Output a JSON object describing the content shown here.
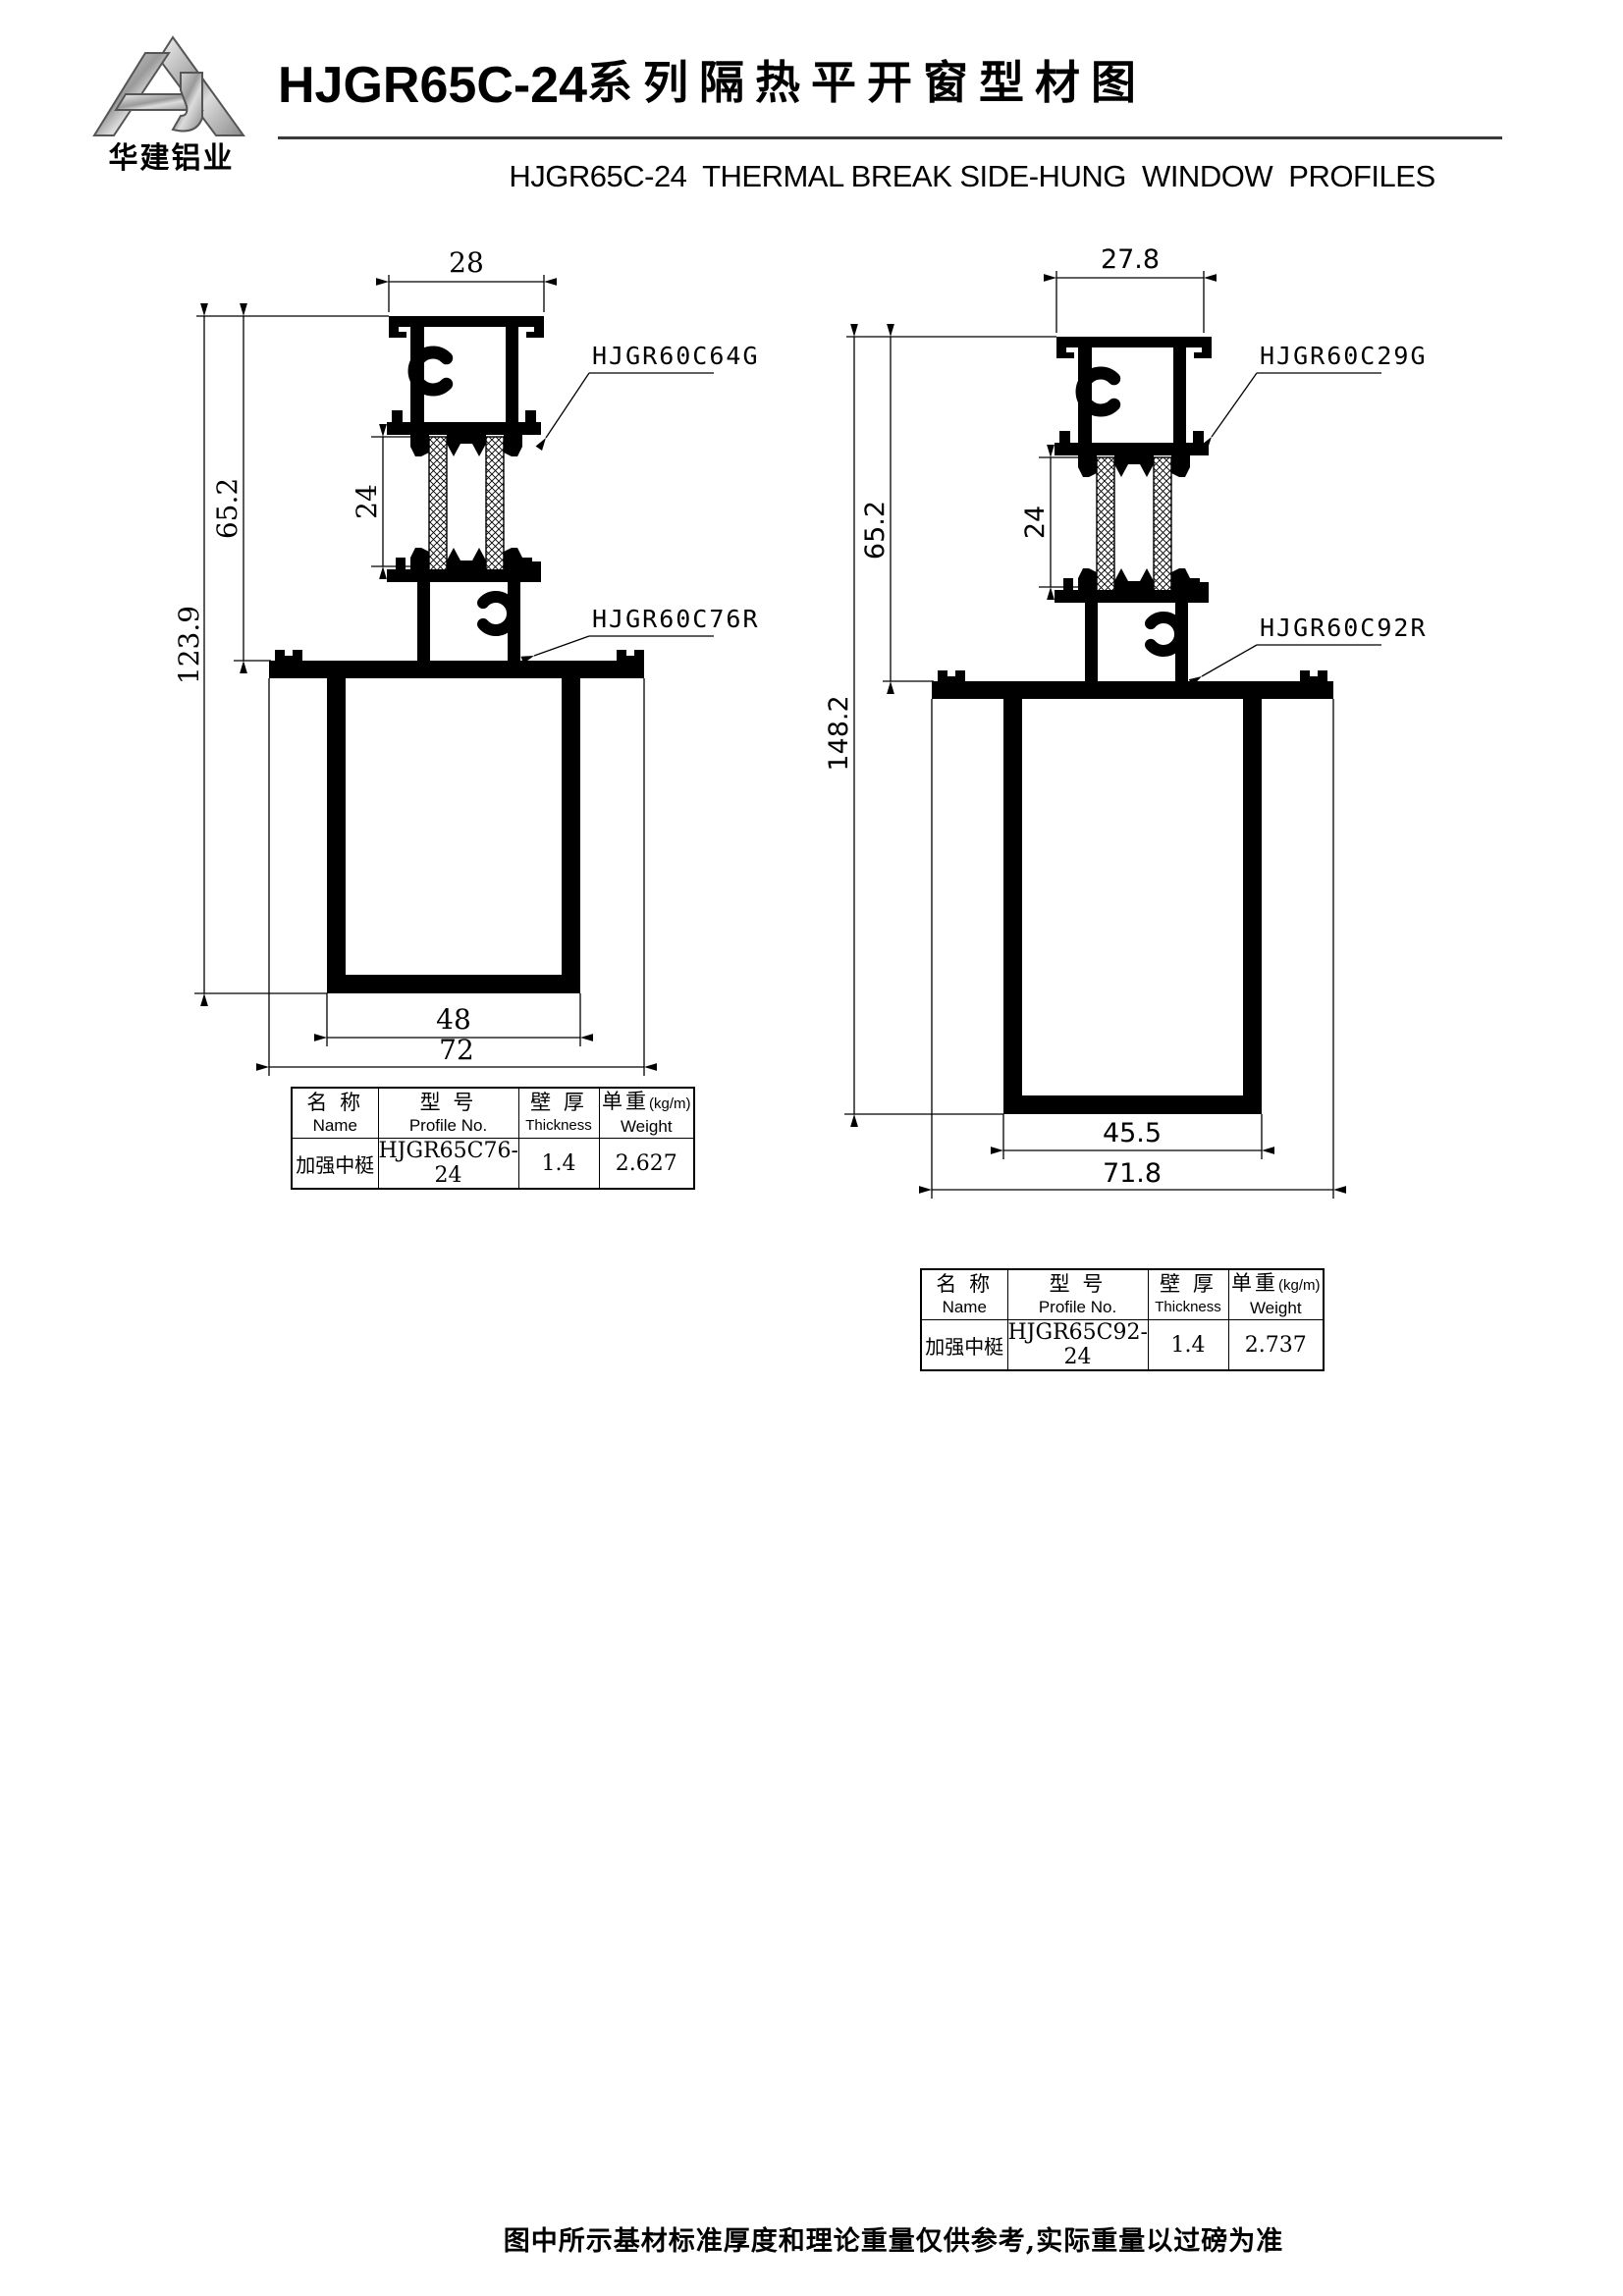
{
  "header": {
    "logo_company": "华建铝业",
    "title_model": "HJGR65C-24",
    "title_text": "系列隔热平开窗型材图",
    "subtitle": "HJGR65C-24  THERMAL BREAK SIDE-HUNG  WINDOW  PROFILES"
  },
  "drawings": [
    {
      "side": "left",
      "top_profile_label": "HJGR60C64G",
      "bottom_profile_label": "HJGR60C76R",
      "dims": {
        "top_width": "28",
        "insulation_height": "24",
        "upper_height": "65.2",
        "total_height": "123.9",
        "inner_width": "48",
        "overall_width": "72"
      }
    },
    {
      "side": "right",
      "top_profile_label": "HJGR60C29G",
      "bottom_profile_label": "HJGR60C92R",
      "dims": {
        "top_width": "27.8",
        "insulation_height": "24",
        "upper_height": "65.2",
        "total_height": "148.2",
        "inner_width": "45.5",
        "overall_width": "71.8"
      }
    }
  ],
  "tables": [
    {
      "headers": {
        "name_zh": "名 称",
        "name_en": "Name",
        "model_zh": "型 号",
        "model_en": "Profile No.",
        "thickness_zh": "壁 厚",
        "thickness_en": "Thickness",
        "weight_zh": "单重",
        "weight_unit": "(kg/m)",
        "weight_en": "Weight"
      },
      "row": {
        "name": "加强中梃",
        "profile_no": "HJGR65C76-24",
        "thickness": "1.4",
        "weight": "2.627"
      }
    },
    {
      "headers": {
        "name_zh": "名 称",
        "name_en": "Name",
        "model_zh": "型 号",
        "model_en": "Profile No.",
        "thickness_zh": "壁 厚",
        "thickness_en": "Thickness",
        "weight_zh": "单重",
        "weight_unit": "(kg/m)",
        "weight_en": "Weight"
      },
      "row": {
        "name": "加强中梃",
        "profile_no": "HJGR65C92-24",
        "thickness": "1.4",
        "weight": "2.737"
      }
    }
  ],
  "footer_note": "图中所示基材标准厚度和理论重量仅供参考,实际重量以过磅为准"
}
